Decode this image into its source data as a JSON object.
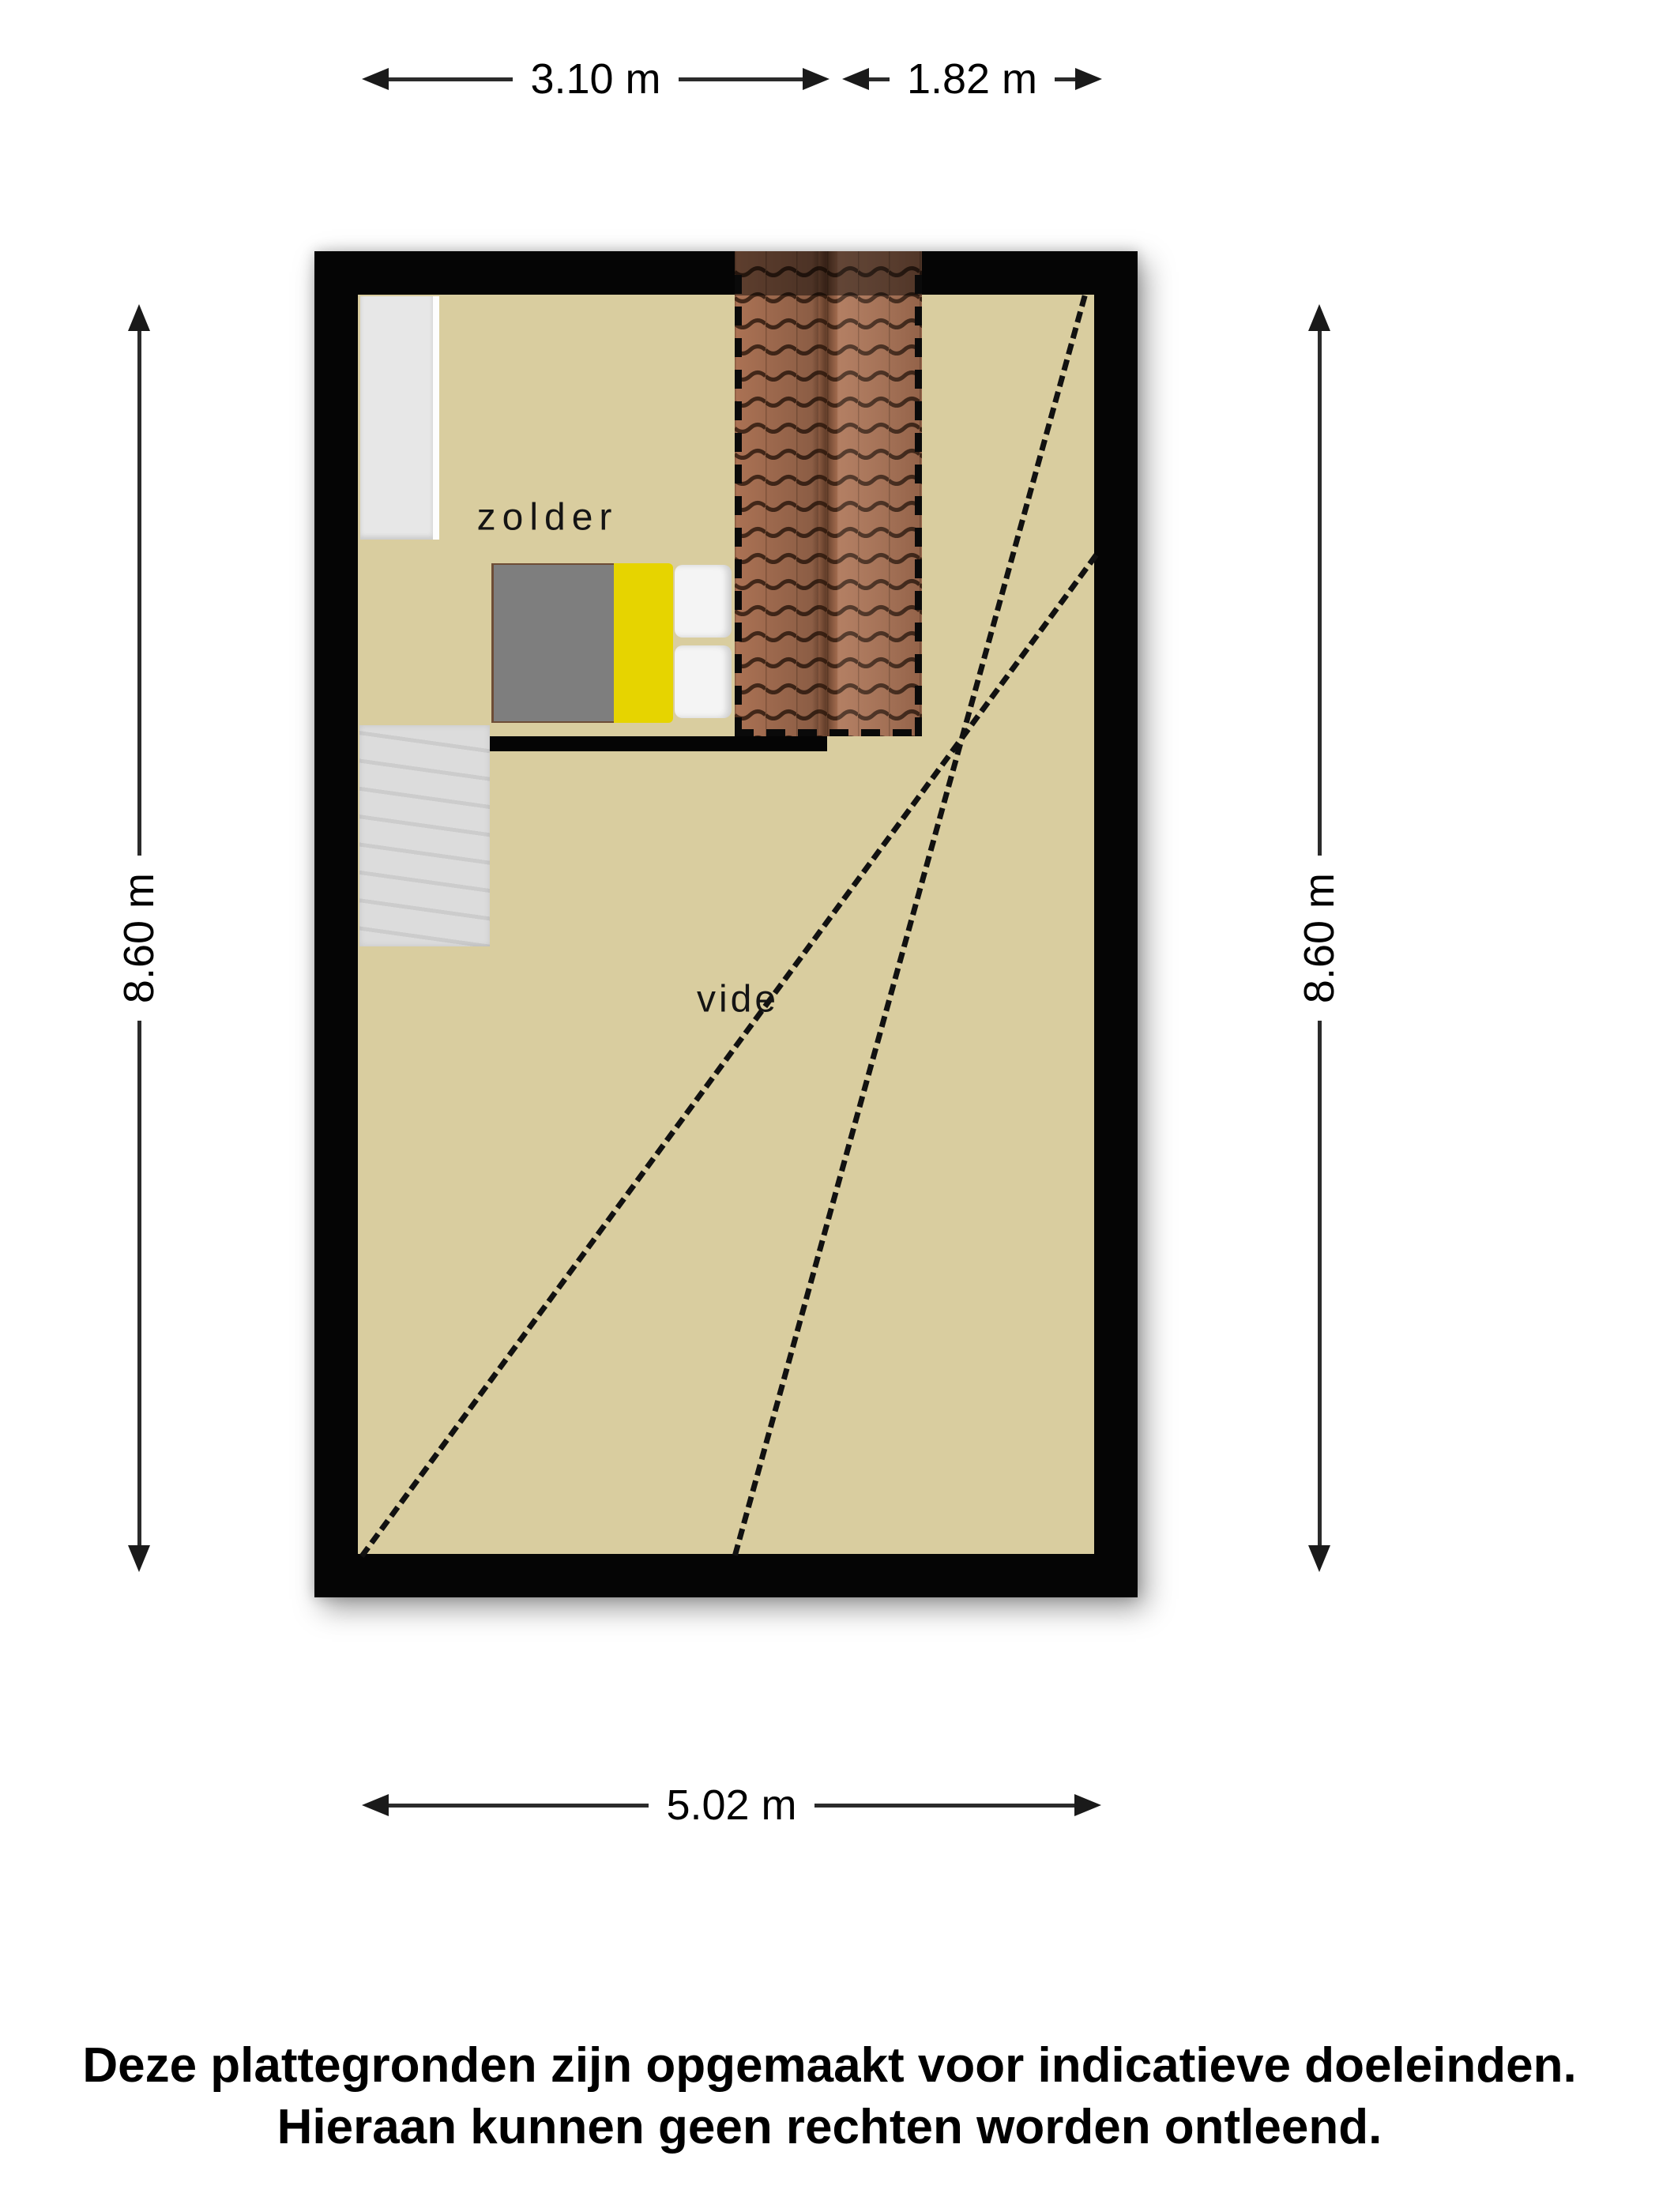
{
  "plan": {
    "rooms": [
      {
        "label": "zolder"
      },
      {
        "label": "vide"
      }
    ],
    "furniture": [
      {
        "name": "closet"
      },
      {
        "name": "staircase"
      },
      {
        "name": "double-bed"
      },
      {
        "name": "roof-window-strip"
      }
    ],
    "colors": {
      "floor": "#d9cd9f",
      "wall": "#050505",
      "roof_tiles": "#ab7254",
      "roof_tile_line": "#45291a",
      "bed_duvet": "#7e7e7e",
      "bed_accent_yellow": "#e6d400",
      "bed_pillow": "#f4f4f4",
      "closet": "#e7e7e7",
      "stairs": "#d5d5d5"
    }
  },
  "dimensions": {
    "top_left": {
      "label": "3.10 m"
    },
    "top_right": {
      "label": "1.82 m"
    },
    "left": {
      "label": "8.60 m"
    },
    "right": {
      "label": "8.60 m"
    },
    "bottom": {
      "label": "5.02 m"
    }
  },
  "disclaimer": {
    "line1": "Deze plattegronden zijn opgemaakt voor indicatieve doeleinden.",
    "line2": "Hieraan kunnen geen rechten worden ontleend."
  }
}
